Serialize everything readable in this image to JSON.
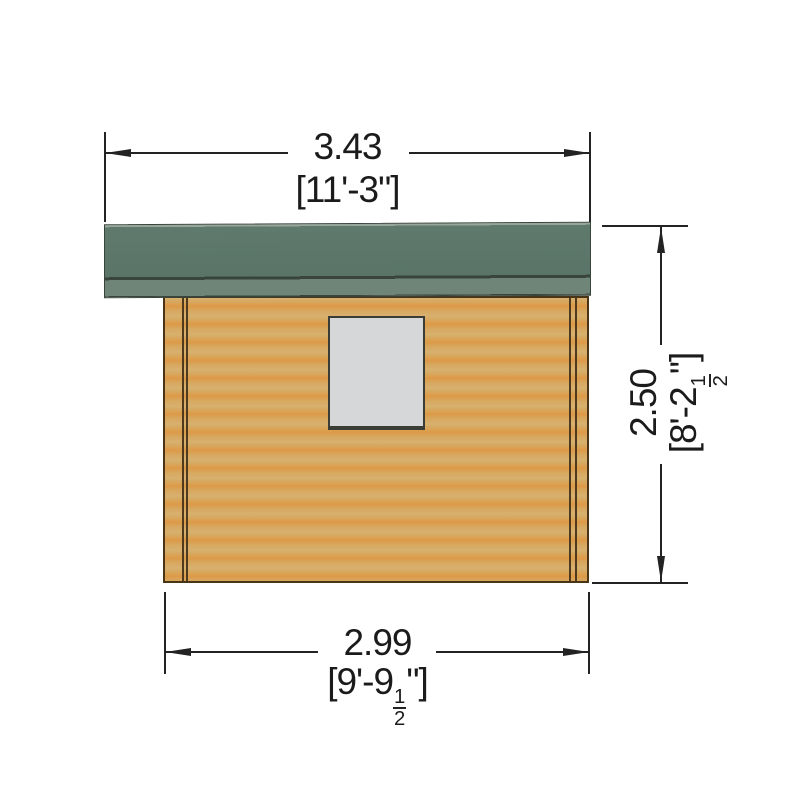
{
  "drawing": {
    "dimensions": {
      "overall_width": {
        "metric": "3.43",
        "imperial": "[11'-3\"]"
      },
      "wall_width": {
        "metric": "2.99",
        "imperial_open": "[9'-9",
        "fraction_numerator": "1",
        "fraction_denominator": "2",
        "imperial_close": "\"]"
      },
      "height": {
        "metric": "2.50",
        "imperial_open": "[8'-2",
        "fraction_numerator": "1",
        "fraction_denominator": "2",
        "imperial_close": "\"]"
      }
    }
  },
  "colors": {
    "line": "#232323",
    "text": "#1b1b1b",
    "roof-main": "#5f7a6c",
    "roof-fascia": "#6e8577",
    "roof-highlight": "#96a698",
    "roof-line": "#39453c",
    "wood-light": "#d8b170",
    "wood-mid": "#d7a65d",
    "wood-dark": "#de9a47",
    "wall-outline": "#4a3418",
    "trim-line": "#503a1d",
    "window-fill": "#d6d7d9",
    "window-frame": "#3c3c37",
    "background": "#ffffff"
  }
}
